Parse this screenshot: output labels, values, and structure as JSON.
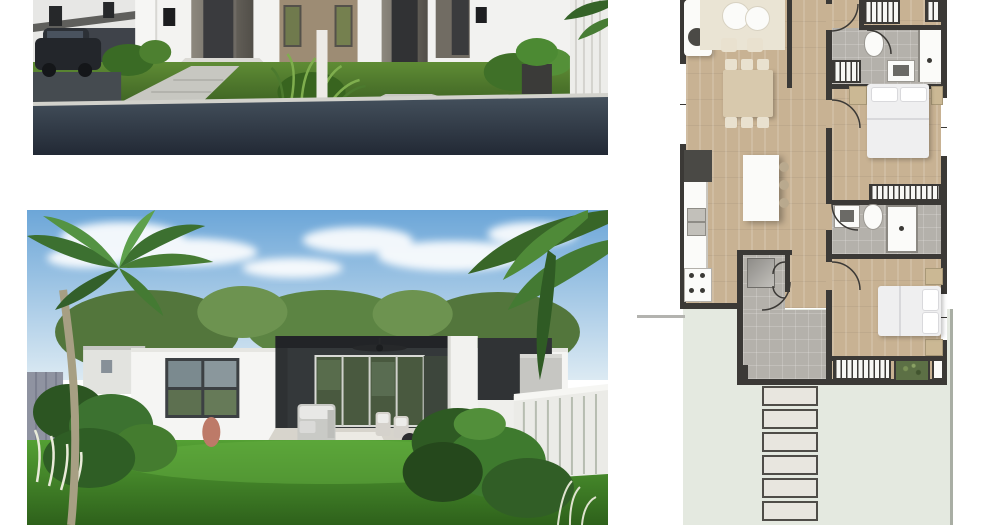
{
  "meta": {
    "type": "real-estate-listing-composite",
    "canvas": {
      "width": 1000,
      "height": 525
    },
    "background": "#ffffff"
  },
  "sections": {
    "street_photo": {
      "name": "street-view-render",
      "description": "Exterior render of white single-storey duplex homes with dark recessed entries, tan feature wall, front lawns, concrete paths, parked dark car, white fence, palm fronds and asphalt road"
    },
    "backyard_photo": {
      "name": "backyard-render",
      "description": "Backyard render of a white flat-roof house with covered alfresco patio, ceiling fan, sliding glass doors, outdoor lounge setting, green lawn, palm trees, garden beds and white picket fence under blue cloudy sky"
    },
    "floor_plan": {
      "name": "floor-plan",
      "description": "Colour floor plan: open living and dining with timber floor, galley kitchen with island bench, hallway, two grey-tiled bathrooms, bedrooms with built-in robes, tiled laundry entry, storage, rear yard with paver path and garden bed"
    }
  },
  "floor_plan": {
    "rooms": [
      {
        "name": "living-dining",
        "floor": "timber"
      },
      {
        "name": "kitchen",
        "floor": "timber"
      },
      {
        "name": "hallway",
        "floor": "timber"
      },
      {
        "name": "bathroom-1",
        "floor": "grey-tile"
      },
      {
        "name": "bedroom-1",
        "floor": "timber"
      },
      {
        "name": "bathroom-2",
        "floor": "grey-tile"
      },
      {
        "name": "bedroom-2",
        "floor": "timber"
      },
      {
        "name": "laundry-entry",
        "floor": "grey-tile"
      },
      {
        "name": "storage",
        "floor": "grey-tile"
      },
      {
        "name": "outdoor-yard",
        "floor": "lawn"
      }
    ],
    "fixtures": {
      "dining_seats": 6,
      "island_bench": 1,
      "beds": 2,
      "toilets": 2,
      "showers": 2,
      "vanities": 2,
      "wardrobe_runs": 5,
      "paver_slabs": 6,
      "garden_beds": 1,
      "sofa": 1,
      "fridge": 1,
      "cooktop_burners": 4
    }
  },
  "palette": {
    "page_bg": "#ffffff",
    "plan_wall": "#3b3936",
    "plan_wood": "#c8b293",
    "plan_tile": "#b4b1ab",
    "plan_sage": "#e4e9e0",
    "plan_paver": "#e8e6df",
    "plan_paver_border": "#4f4d48",
    "plan_white": "#fbfbf9",
    "plan_plant": "#5c7045",
    "plan_rug": "#eae4d4",
    "plan_table": "#d8c9ad",
    "plan_chair": "#e9e1cf",
    "plan_timber_furn": "#cbb894",
    "photo_road": "#2c3540",
    "photo_lawn": "#4e8030",
    "photo_wall_white": "#f3f3f1",
    "photo_door_dark": "#35363a",
    "photo_tan_wall": "#9d8c74",
    "photo_sky_top": "#6ca6d8",
    "photo_sky_bottom": "#dceaf3",
    "photo_palm_green": "#3c7030",
    "photo_glass_green": "#49593f",
    "photo_fence_white": "#ebebe7"
  }
}
